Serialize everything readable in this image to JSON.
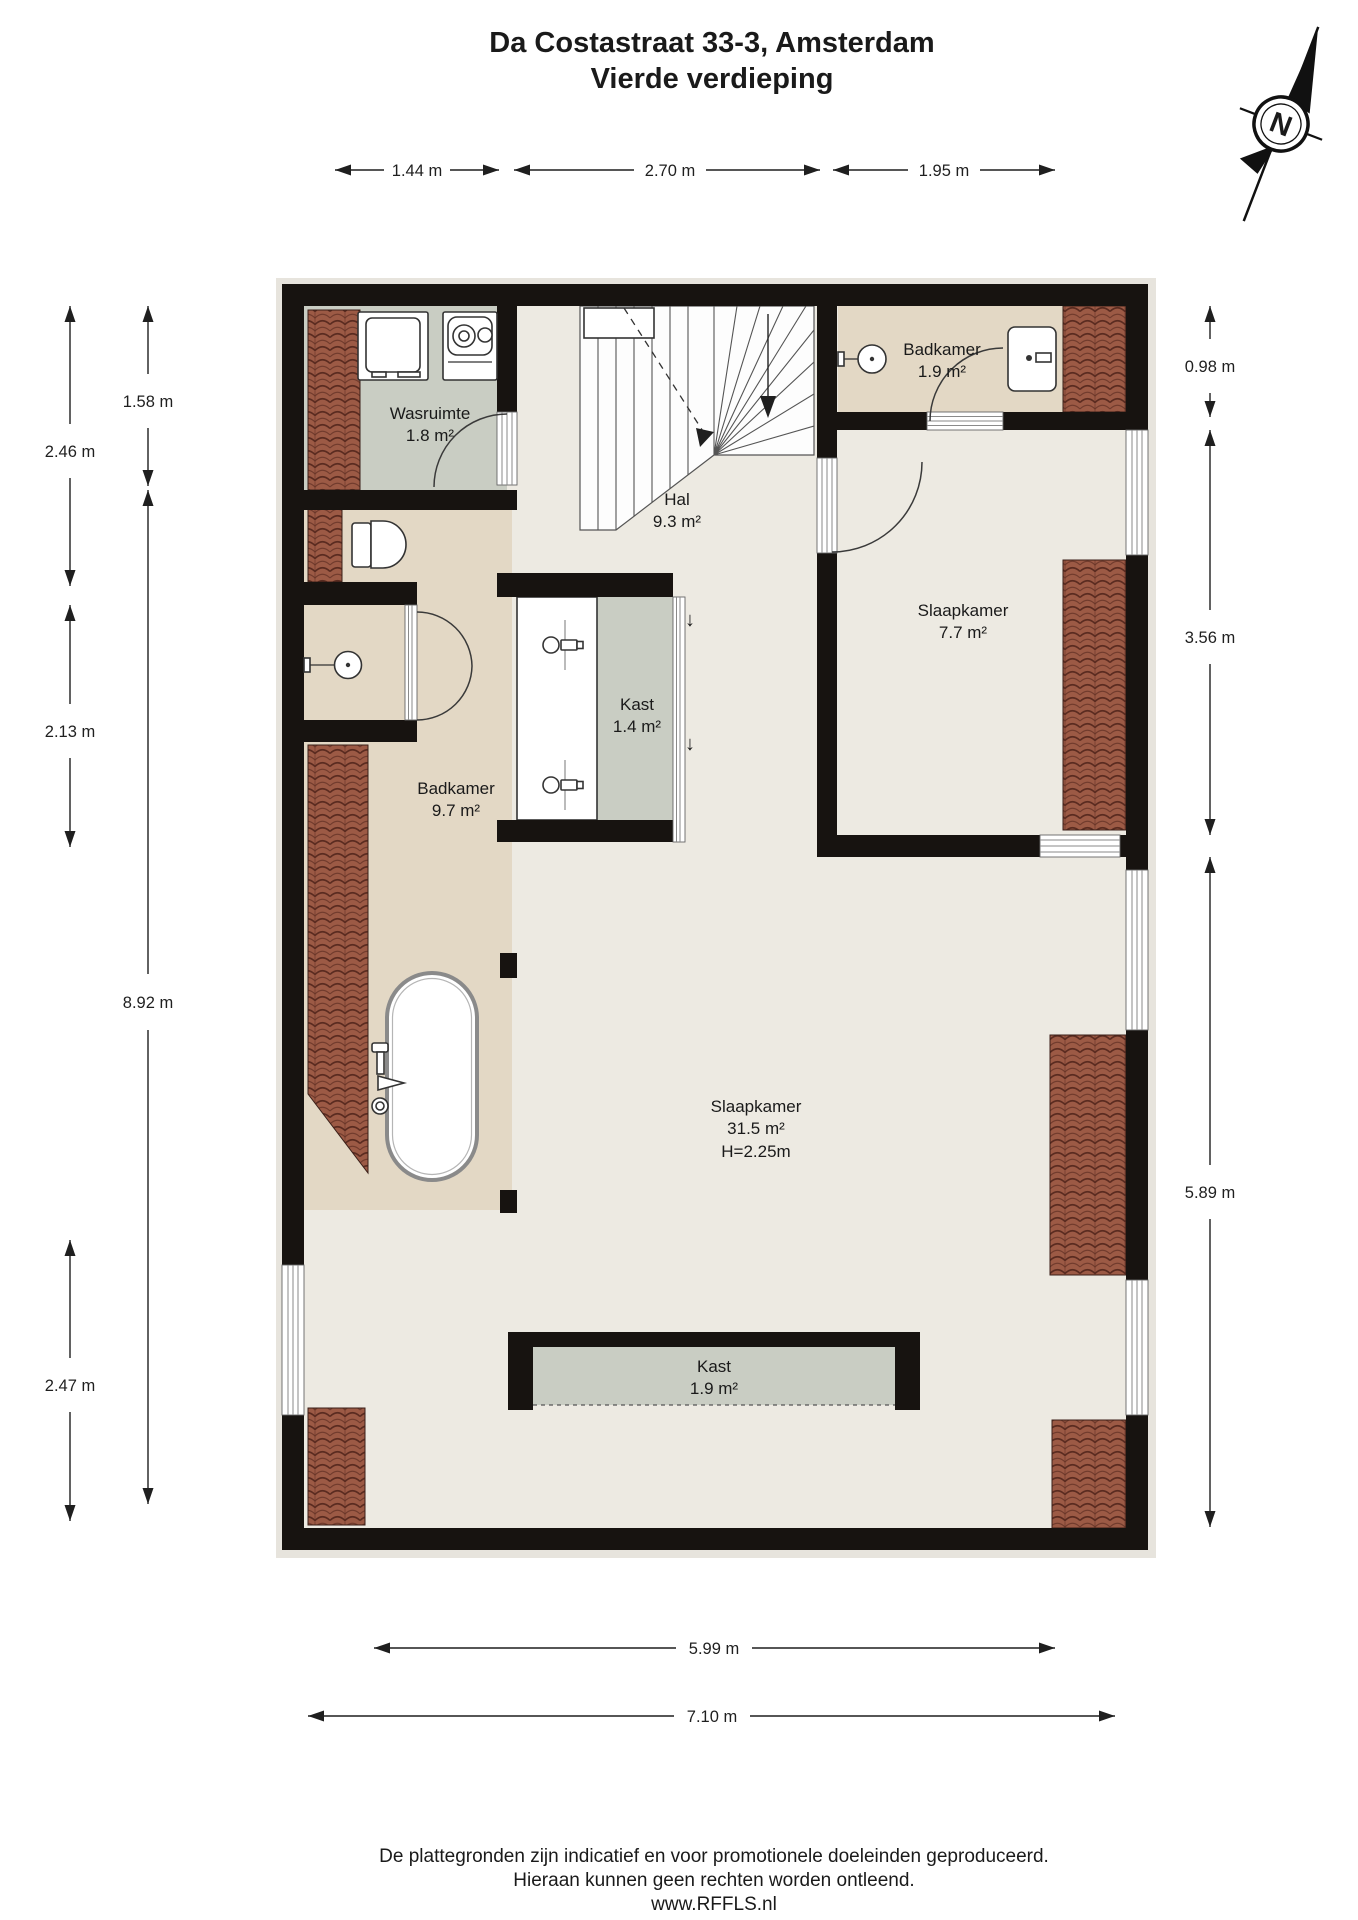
{
  "title": {
    "line1": "Da Costastraat 33-3, Amsterdam",
    "line2": "Vierde verdieping"
  },
  "compass": {
    "north_label": "N"
  },
  "rooms": {
    "wasruimte": {
      "name": "Wasruimte",
      "area": "1.8 m²"
    },
    "hal": {
      "name": "Hal",
      "area": "9.3 m²"
    },
    "badkamer_boven": {
      "name": "Badkamer",
      "area": "1.9 m²"
    },
    "slaapkamer_klein": {
      "name": "Slaapkamer",
      "area": "7.7 m²"
    },
    "kast_hal": {
      "name": "Kast",
      "area": "1.4 m²"
    },
    "badkamer_groot": {
      "name": "Badkamer",
      "area": "9.7 m²"
    },
    "slaapkamer_groot": {
      "name": "Slaapkamer",
      "area": "31.5 m²",
      "height": "H=2.25m"
    },
    "kast_slaapkamer": {
      "name": "Kast",
      "area": "1.9 m²"
    }
  },
  "dimensions": {
    "top": [
      "1.44 m",
      "2.70 m",
      "1.95 m"
    ],
    "left_outer": [
      "2.46 m",
      "2.13 m",
      "2.47 m"
    ],
    "left_inner": [
      "1.58 m",
      "8.92 m"
    ],
    "right": [
      "0.98 m",
      "3.56 m",
      "5.89 m"
    ],
    "bottom": [
      "5.99 m",
      "7.10 m"
    ]
  },
  "symbols": {
    "down_arrow": "↓"
  },
  "footer": {
    "line1": "De plattegronden zijn indicatief en voor promotionele doeleinden geproduceerd.",
    "line2": "Hieraan kunnen geen rechten worden ontleend.",
    "line3": "www.RFFLS.nl"
  },
  "colors": {
    "wall": "#171310",
    "floor-main": "#edeae2",
    "floor-bath": "#e3d8c5",
    "floor-closet": "#c9cdc3",
    "roof-tile": "#9c5a45",
    "roof-tile-dark": "#5a2b20"
  }
}
